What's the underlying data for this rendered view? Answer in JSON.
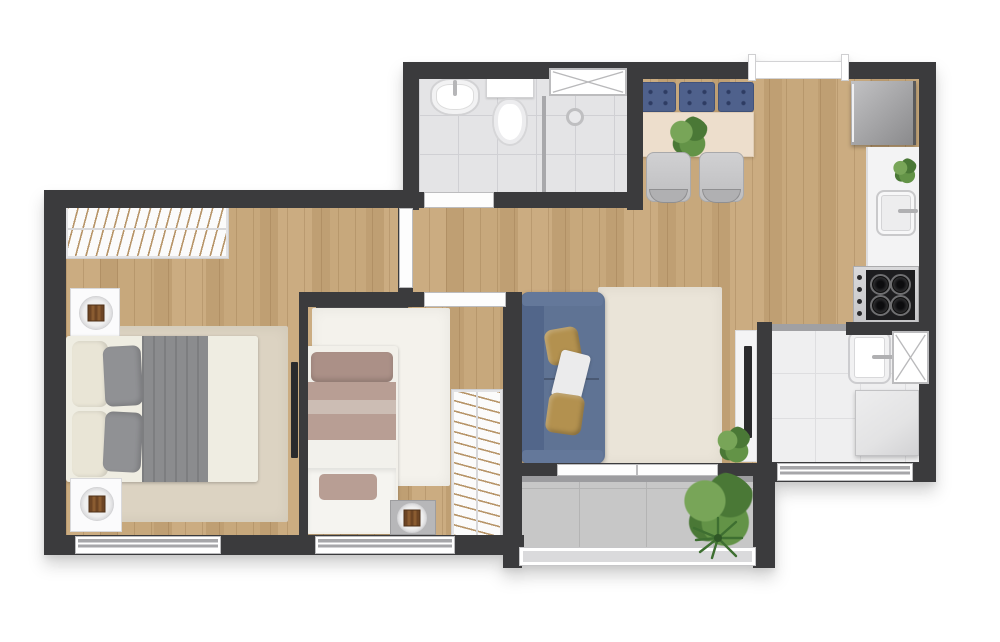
{
  "title": "apartment-floor-plan-top-view",
  "colors": {
    "wall": "#3b3b3d",
    "woodA": "#cbac81",
    "woodB": "#bf9f73",
    "woodC": "#c7a87c",
    "bathTile": "#e4e4e6",
    "bathLine": "#d0d0d4",
    "serviceTile": "#efeff0",
    "serviceLine": "#dedee0",
    "balconyTile": "#c7c7c7",
    "balconyLine": "#b4b4b4",
    "rugMaster": "#dcd3c2",
    "rugSecond": "#f4f2ec",
    "rugLiving": "#eae4d8",
    "sofaBlue": "#5f7394",
    "sofaBack": "#52668a",
    "mustard": "#b3914f",
    "navy": "#4f618c",
    "navyDot": "#2e3c63",
    "tableWood": "#eddecc",
    "chairGray": "#c7c7c9",
    "bedGray": "#8b8c8e",
    "bedCream": "#efede2",
    "pillowCream": "#e9e5d6",
    "pillowGray": "#909194",
    "mauve": "#ab9087",
    "mauveMid": "#b89e94",
    "mauveLight": "#ccbdb4",
    "plantDark": "#4a7836",
    "plantMid": "#639347",
    "plantLight": "#78a558",
    "tv": "#2b2b2d",
    "door": "#fdfdfd",
    "frame": "#bcbcbe",
    "winBand": "#a6a6a9",
    "counter": "#f3f3f4",
    "steel": "#d9d9db",
    "cooktop": "#1d1d1f",
    "shelfDark": "#48484a",
    "hanger": "#b79569",
    "applianceA": "#c2c2c4",
    "applianceB": "#8a8a8c",
    "washer": "#e3e3e4"
  },
  "rooms": {
    "bathroom": {
      "furniture": [
        "sink",
        "toilet",
        "shower",
        "glass-partition",
        "window"
      ]
    },
    "dining-kitchen": {
      "furniture": [
        "bench-navy-cushions",
        "dining-table",
        "table-plant",
        "chair",
        "chair",
        "fridge",
        "counter",
        "counter-plant",
        "kitchen-sink",
        "cooktop-stove",
        "top-window"
      ]
    },
    "living-room": {
      "furniture": [
        "sofa-blue",
        "mustard-pillow",
        "white-throw",
        "mustard-pillow",
        "cream-rug",
        "tv-console",
        "tv",
        "corner-plant"
      ]
    },
    "master-bedroom": {
      "furniture": [
        "wardrobe",
        "nightstand-lamp",
        "double-bed",
        "gray-blanket",
        "rug",
        "nightstand-lamp",
        "wall-tv",
        "window"
      ]
    },
    "second-bedroom": {
      "furniture": [
        "wall-shelf",
        "single-bed",
        "fluffy-rug",
        "side-table-lamp",
        "wardrobe",
        "window"
      ]
    },
    "service-area": {
      "furniture": [
        "laundry-tub",
        "washing-machine",
        "side-window",
        "bottom-window"
      ]
    },
    "balcony": {
      "furniture": [
        "bush-plant",
        "palm-plant",
        "glass-railing",
        "sliding-door"
      ]
    },
    "hall": {
      "furniture": [
        "bathroom-door",
        "bedroom1-door",
        "bedroom2-door"
      ]
    }
  }
}
